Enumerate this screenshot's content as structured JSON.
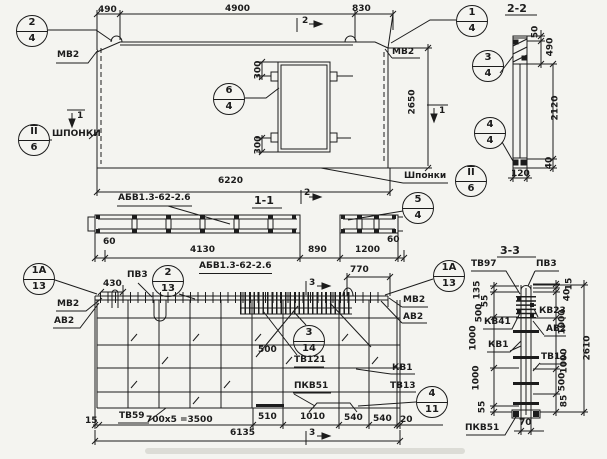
{
  "colors": {
    "paper": "#f4f4f0",
    "ink": "#1c1c1c"
  },
  "plan": {
    "dim_490": "490",
    "dim_4900": "4900",
    "dim_830": "830",
    "dim_6220": "6220",
    "dim_2650": "2650",
    "dim_300_top": "300",
    "dim_300_bottom": "300",
    "label_mv2_left": "МВ2",
    "label_mv2_right": "МВ2",
    "label_shponki_left": "ШПОНКИ",
    "label_shponki_right": "Шпонки",
    "mark_1_left": "1",
    "mark_1_right": "1",
    "mark_2_top": "2",
    "mark_2_mid": "2"
  },
  "section22": {
    "title": "2-2",
    "dim_50": "50",
    "dim_490": "490",
    "dim_2120": "2120",
    "dim_40": "40",
    "dim_120": "120"
  },
  "section11": {
    "title": "1-1",
    "label_abv": "АБВ1.3-62-2.6",
    "dim_60_left": "60",
    "dim_4130": "4130",
    "dim_890": "890",
    "dim_1200": "1200",
    "dim_60_right": "60"
  },
  "elevation": {
    "label_abv": "АБВ1.3-62-2.6",
    "dim_430": "430",
    "dim_770": "770",
    "dim_500": "500",
    "label_pv3": "ПВ3",
    "label_mv2_left": "МВ2",
    "label_av2_left": "АВ2",
    "label_mv2_right": "МВ2",
    "label_av2_right": "АВ2",
    "label_tv121": "ТВ121",
    "label_kv1": "КВ1",
    "label_pkv51": "ПКВ51",
    "label_tv13": "ТВ13",
    "label_tv59": "ТВ59",
    "dim_15": "15",
    "dim_700x5": "700х5 =3500",
    "dim_510": "510",
    "dim_1010": "1010",
    "dim_540_a": "540",
    "dim_540_b": "540",
    "dim_20": "20",
    "dim_6135": "6135",
    "mark_3_top": "3",
    "mark_3_bottom": "3"
  },
  "section33": {
    "title": "3-3",
    "label_tv97": "ТВ97",
    "label_pv3": "ПВ3",
    "label_kv23": "КВ23",
    "label_av2": "АВ2",
    "label_kv41": "КВ41",
    "label_kv1": "КВ1",
    "label_tv13": "ТВ13",
    "label_pkv51": "ПКВ51",
    "dim_70": "70",
    "dims_left": {
      "d135": "135",
      "d55_top": "55",
      "d500": "500",
      "d1000_a": "1000",
      "d1000_b": "1000",
      "d55_bottom": "55"
    },
    "dims_right": {
      "d15": "15",
      "d40": "40",
      "d1000_a": "1000",
      "d1000_b": "1000",
      "d500": "500",
      "d85": "85",
      "d2610": "2610"
    }
  },
  "callouts": {
    "c2_4": {
      "top": "2",
      "bottom": "4"
    },
    "c1_4": {
      "top": "1",
      "bottom": "4"
    },
    "c6_4": {
      "top": "6",
      "bottom": "4"
    },
    "cII6_left": {
      "top": "II",
      "bottom": "6"
    },
    "cII6_right": {
      "top": "II",
      "bottom": "6"
    },
    "c3_4": {
      "top": "3",
      "bottom": "4"
    },
    "c4_4": {
      "top": "4",
      "bottom": "4"
    },
    "c5_4": {
      "top": "5",
      "bottom": "4"
    },
    "c1A13_left": {
      "top": "1А",
      "bottom": "13"
    },
    "c2_13": {
      "top": "2",
      "bottom": "13"
    },
    "c3_14": {
      "top": "3",
      "bottom": "14"
    },
    "c1A13_right": {
      "top": "1А",
      "bottom": "13"
    },
    "c4_11": {
      "top": "4",
      "bottom": "11"
    }
  }
}
